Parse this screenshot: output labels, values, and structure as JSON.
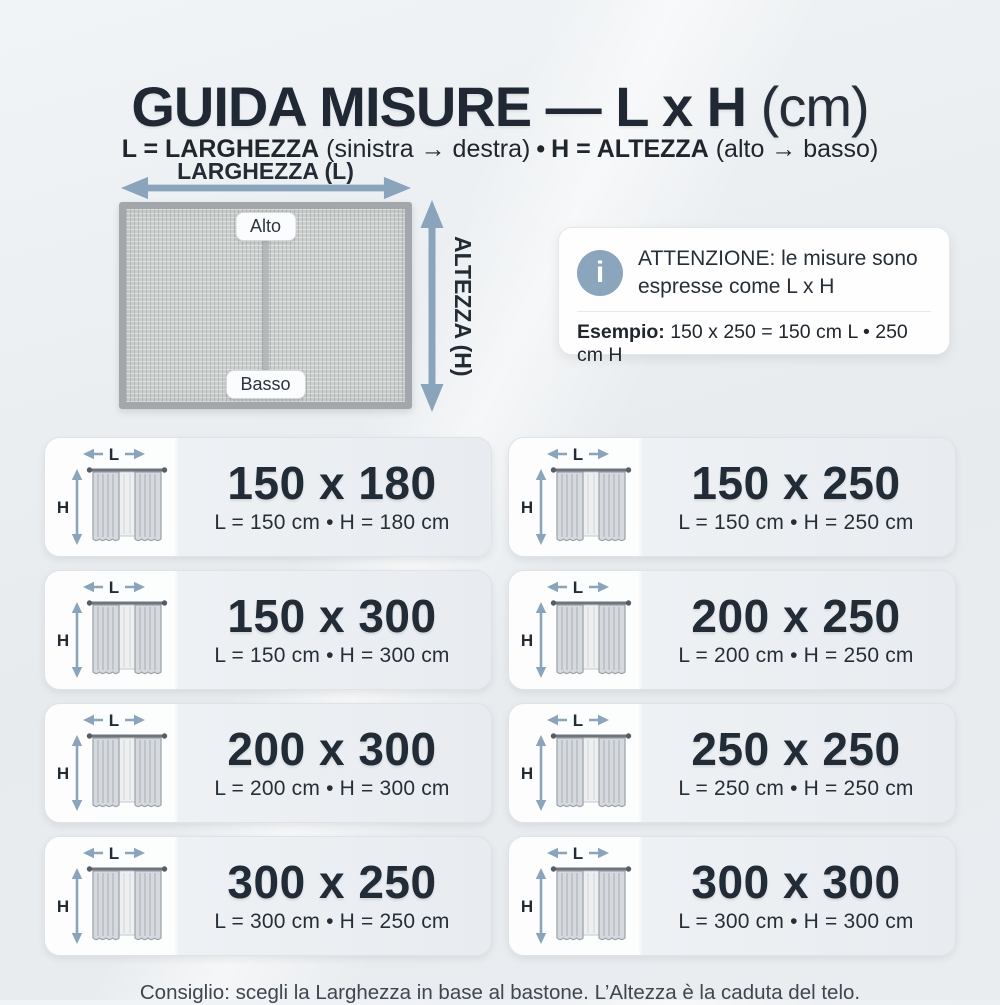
{
  "header": {
    "title_main": "GUIDA MISURE — L x H",
    "title_unit": "(cm)",
    "subtitle": {
      "l_bold": "L = LARGHEZZA",
      "l_note": "(sinistra → destra)",
      "separator": "•",
      "h_bold": "H = ALTEZZA",
      "h_note": "(alto → basso)"
    }
  },
  "diagram": {
    "width_label": "LARGHEZZA (L)",
    "height_label": "ALTEZZA (H)",
    "top_label": "Alto",
    "bottom_label": "Basso"
  },
  "attention": {
    "icon_glyph": "i",
    "message": "ATTENZIONE: le misure sono espresse come L x H",
    "example_label": "Esempio:",
    "example_value": "150 x 250 = 150 cm L • 250 cm H"
  },
  "cards_common": {
    "l_label": "L",
    "h_label": "H"
  },
  "cards": [
    {
      "size": "150 x 180",
      "detail": "L = 150 cm • H = 180 cm"
    },
    {
      "size": "150 x 250",
      "detail": "L = 150 cm • H = 250 cm"
    },
    {
      "size": "150 x 300",
      "detail": "L = 150 cm • H = 300 cm"
    },
    {
      "size": "200 x 250",
      "detail": "L = 200 cm • H = 250 cm"
    },
    {
      "size": "200 x 300",
      "detail": "L = 200 cm • H = 300 cm"
    },
    {
      "size": "250 x 250",
      "detail": "L = 250 cm • H = 250 cm"
    },
    {
      "size": "300 x 250",
      "detail": "L = 300 cm • H = 250 cm"
    },
    {
      "size": "300 x 300",
      "detail": "L = 300 cm • H = 300 cm"
    }
  ],
  "footer": {
    "text": "Consiglio: scegli la Larghezza in base al bastone. L’Altezza è la caduta del telo."
  },
  "colors": {
    "accent_arrow": "#8aa4bc",
    "text_dark": "#222b36",
    "page_bg": "#e9edf0",
    "card_bg_left": "#fdfdfe",
    "card_bg_right": "#e8ecf0"
  }
}
